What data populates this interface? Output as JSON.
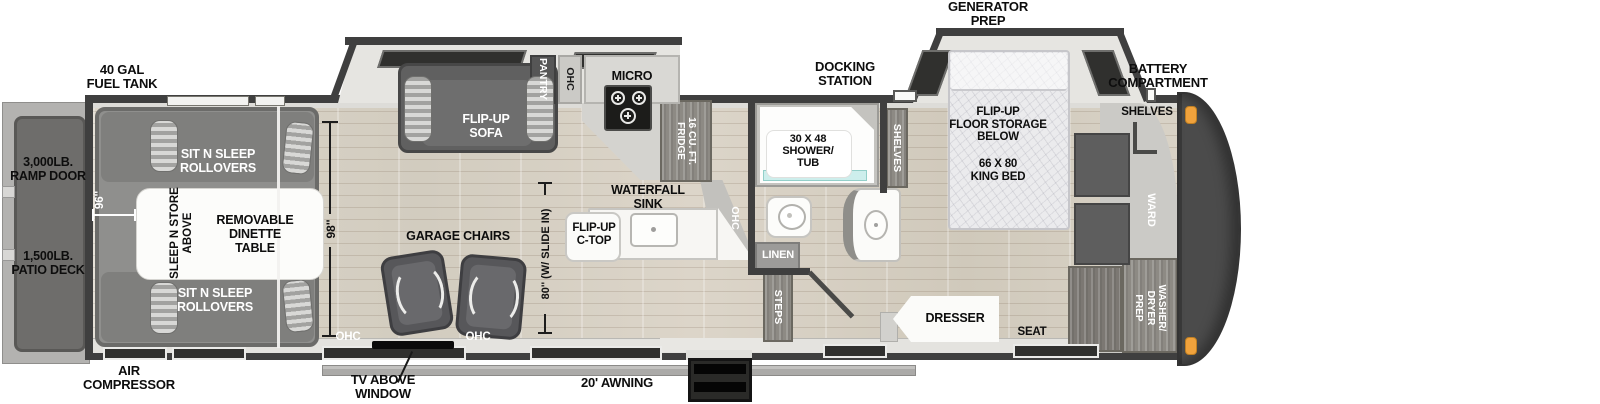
{
  "title": "Toy hauler fifth wheel floorplan",
  "colors": {
    "wall": "#3f3f3f",
    "wood_floor": "#d8d2c6",
    "slide_floor": "#e6e5e1",
    "deck": "#6e6d6b",
    "furniture_dark": "#5d5d5d",
    "furniture_white": "#fbfbfa",
    "accent_orange": "#f0a23c",
    "shower_glass": "#cdeeec"
  },
  "exterior": {
    "fuel_tank": [
      "40 GAL",
      "FUEL TANK"
    ],
    "generator_prep": [
      "GENERATOR",
      "PREP"
    ],
    "docking_station": [
      "DOCKING",
      "STATION"
    ],
    "battery_compartment": [
      "BATTERY",
      "COMPARTMENT"
    ],
    "air_compressor": [
      "AIR",
      "COMPRESSOR"
    ],
    "tv_above_window": [
      "TV ABOVE",
      "WINDOW"
    ],
    "awning": "20' AWNING",
    "ramp_door": [
      "3,000LB.",
      "RAMP DOOR"
    ],
    "patio_deck": [
      "1,500LB.",
      "PATIO DECK"
    ]
  },
  "garage": {
    "sit_n_sleep_top": [
      "SIT N SLEEP",
      "ROLLOVERS"
    ],
    "sit_n_sleep_bottom": [
      "SIT N SLEEP",
      "ROLLOVERS"
    ],
    "sleep_n_store": [
      "SLEEP N STORE",
      "ABOVE"
    ],
    "dinette": [
      "REMOVABLE",
      "DINETTE",
      "TABLE"
    ],
    "width_dim": "96''"
  },
  "living": {
    "flip_up_sofa": [
      "FLIP-UP",
      "SOFA"
    ],
    "garage_chairs": "GARAGE CHAIRS",
    "ohc_left": "OHC",
    "ohc_right": "OHC",
    "length_dim": "98''",
    "slide_dim": "80'' (W/ SLIDE IN)"
  },
  "kitchen": {
    "pantry": "PANTRY",
    "ohc_upper": "OHC",
    "micro": "MICRO",
    "fridge": [
      "16 CU. FT.",
      "FRIDGE"
    ],
    "waterfall_sink": [
      "WATERFALL",
      "SINK"
    ],
    "flip_up_ctop": [
      "FLIP-UP",
      "C-TOP"
    ],
    "ohc_island": "OHC"
  },
  "bath": {
    "shower": [
      "30 X 48",
      "SHOWER/",
      "TUB"
    ],
    "linen": "LINEN",
    "steps": "STEPS",
    "shelves": "SHELVES"
  },
  "bedroom": {
    "floor_storage": [
      "FLIP-UP",
      "FLOOR STORAGE",
      "BELOW"
    ],
    "king_bed": [
      "66 X 80",
      "KING BED"
    ],
    "dresser": "DRESSER",
    "seat": "SEAT",
    "shelves": "SHELVES",
    "ward": "WARD",
    "washer_dryer": [
      "WASHER/",
      "DRYER",
      "PREP"
    ]
  }
}
